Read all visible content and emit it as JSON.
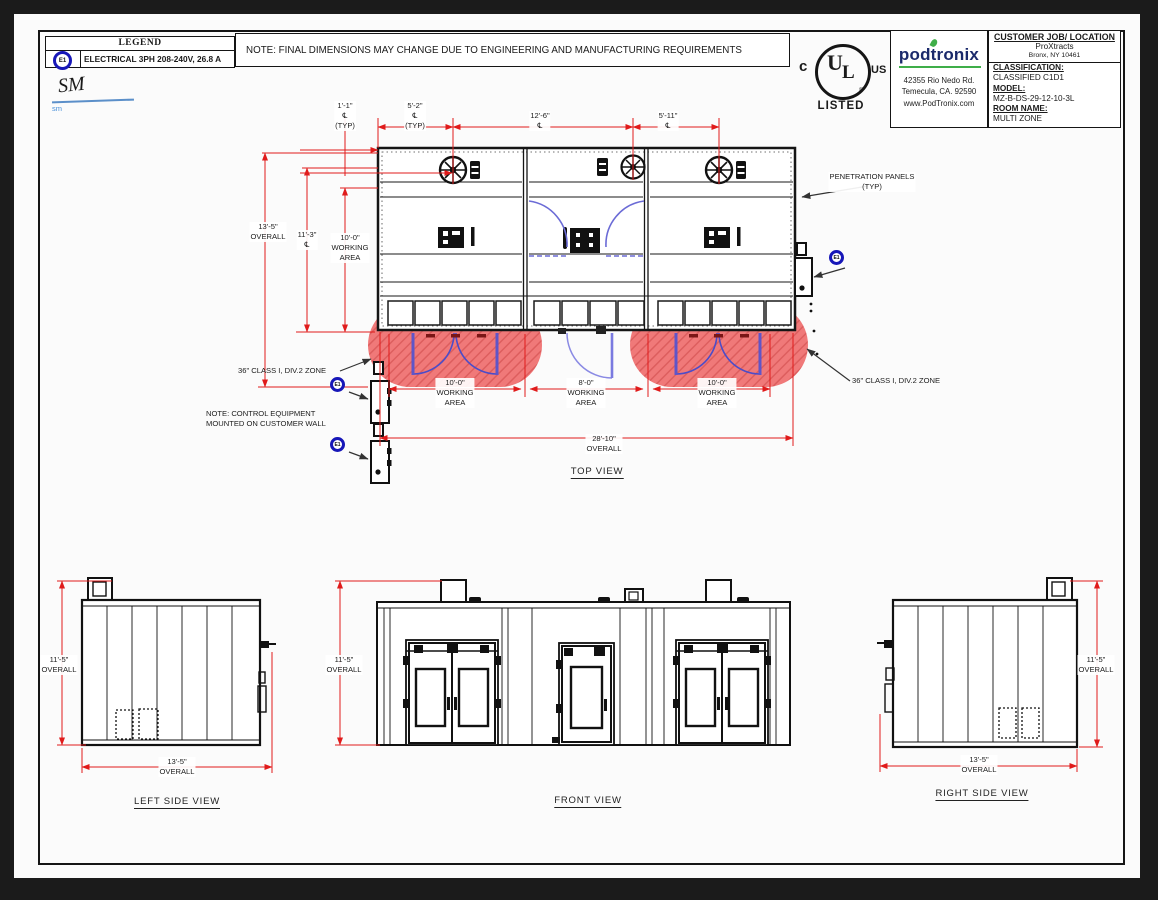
{
  "sheet": {
    "legend": {
      "title": "LEGEND",
      "symbol": "E1",
      "entry": "ELECTRICAL 3PH 208-240V, 26.8 A"
    },
    "signature": {
      "initials": "SM",
      "annotation": "sm"
    },
    "top_note": "NOTE: FINAL DIMENSIONS MAY CHANGE DUE TO ENGINEERING AND MANUFACTURING REQUIREMENTS",
    "ul_mark": {
      "c": "c",
      "u": "U",
      "l": "L",
      "us": "US",
      "registered": "®",
      "listed": "LISTED"
    },
    "company": {
      "name": "podtronix",
      "address_line1": "42355 Rio Nedo Rd.",
      "address_line2": "Temecula, CA. 92590",
      "website": "www.PodTronix.com"
    },
    "job_block": {
      "header": "CUSTOMER JOB/ LOCATION",
      "customer": "ProXtracts",
      "location": "Bronx, NY 10461",
      "classification_label": "CLASSIFICATION:",
      "classification": "CLASSIFIED  C1D1",
      "model_label": "MODEL:",
      "model": "MZ-B-DS-29-12-10-3L",
      "room_label": "ROOM NAME:",
      "room": "MULTI ZONE"
    },
    "colors": {
      "dimension_red": "#e01b1b",
      "zone_red": "#ef6b6b",
      "door_blue": "#5c55c8",
      "accent_blue": "#1717b8"
    }
  },
  "top_view": {
    "title": "TOP VIEW",
    "dim_fan_offset": "1'-1\"\n℄\n(TYP)",
    "dim_fan_left": "5'-2\"\n℄\n(TYP)",
    "dim_fan_mid": "12'-6\"\n℄",
    "dim_fan_right": "5'-11\"\n℄",
    "dim_depth_overall": "13'-5\"\nOVERALL",
    "dim_depth_cl": "11'-3\"\n℄",
    "dim_depth_working": "10'-0\"\nWORKING\nAREA",
    "dim_working_left": "10'-0\"\nWORKING\nAREA",
    "dim_working_mid": "8'-0\"\nWORKING\nAREA",
    "dim_working_right": "10'-0\"\nWORKING\nAREA",
    "dim_width_overall": "28'-10\"\nOVERALL",
    "penetration_label": "PENETRATION PANELS\n(TYP)",
    "zone_label_left": "36\" CLASS I, DIV.2 ZONE",
    "zone_label_right": "36\" CLASS I, DIV.2 ZONE",
    "control_note": "NOTE:  CONTROL EQUIPMENT\nMOUNTED ON CUSTOMER WALL",
    "e1_symbol": "E1"
  },
  "side_views": {
    "left_title": "LEFT SIDE VIEW",
    "front_title": "FRONT VIEW",
    "right_title": "RIGHT SIDE VIEW",
    "dim_height_left": "11'-5\"\nOVERALL",
    "dim_height_front": "11'-5\"\nOVERALL",
    "dim_height_right": "11'-5\"\nOVERALL",
    "dim_width_left": "13'-5\"\nOVERALL",
    "dim_width_right": "13'-5\"\nOVERALL"
  }
}
